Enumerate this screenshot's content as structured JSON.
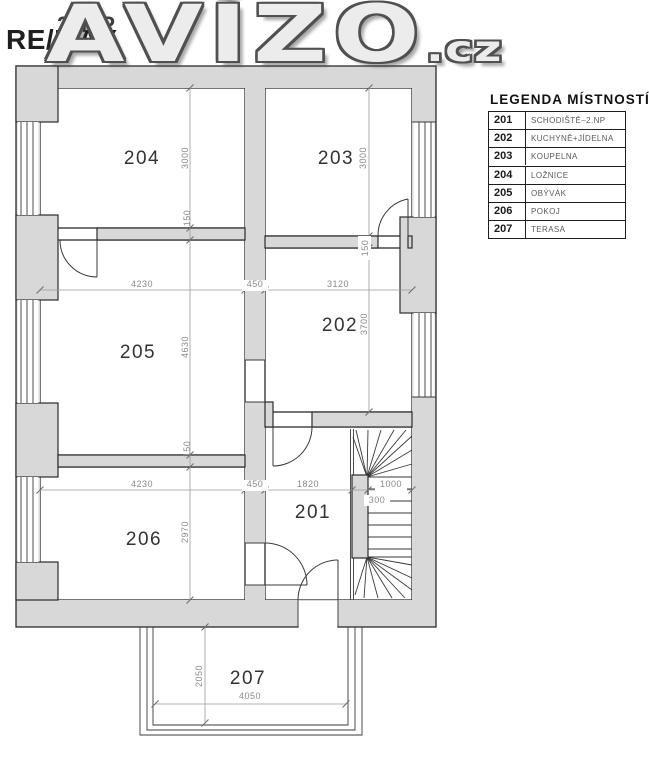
{
  "watermark": {
    "floor_label": "2.NP",
    "brand": "RE/MAX",
    "site": "AVÍZO",
    "site_tld": ".cz"
  },
  "legend": {
    "title": "LEGENDA MÍSTNOSTÍ",
    "rows": [
      {
        "number": "201",
        "name": "SCHODIŠTĚ–2.NP"
      },
      {
        "number": "202",
        "name": "KUCHYNĚ+JÍDELNA"
      },
      {
        "number": "203",
        "name": "KOUPELNA"
      },
      {
        "number": "204",
        "name": "LOŽNICE"
      },
      {
        "number": "205",
        "name": "OBÝVÁK"
      },
      {
        "number": "206",
        "name": "POKOJ"
      },
      {
        "number": "207",
        "name": "TERASA"
      }
    ]
  },
  "plan": {
    "room_numbers": {
      "r201": "201",
      "r202": "202",
      "r203": "203",
      "r204": "204",
      "r205": "205",
      "r206": "206",
      "r207": "207"
    },
    "dims": {
      "w_205": "4230",
      "wall_mid_top": "450",
      "w_202": "3120",
      "w_206": "4230",
      "wall_mid_bottom": "450",
      "w_201": "1820",
      "w_stairs": "1000",
      "stair_300": "300",
      "h_204": "3000",
      "wall_150_left_top": "150",
      "h_205": "4630",
      "wall_150_left_bottom": "150",
      "h_206": "2970",
      "h_203": "3000",
      "wall_150_right": "150",
      "h_202": "3700",
      "terrace_depth": "2050",
      "terrace_width": "4050"
    }
  },
  "colors": {
    "wall_fill": "#d8d8d8",
    "outline": "#2b2b2b",
    "dim": "#8a8a8a",
    "watermark_fill": "#ececec",
    "watermark_outline": "#505050"
  }
}
